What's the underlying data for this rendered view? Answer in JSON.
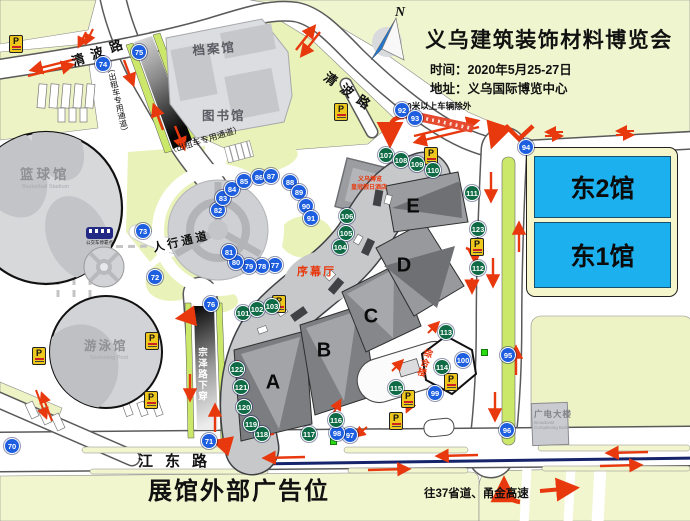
{
  "header": {
    "title": "义乌建筑装饰材料博览会",
    "time": "时间：2020年5月25-27日",
    "address": "地址：义乌国际博览中心",
    "restriction_note": "0米以上车辆除外"
  },
  "compass": {
    "north": "N"
  },
  "roads": {
    "qingbo_west": "清波路",
    "qingbo_east": "清波路",
    "jiangdong": "江东路",
    "zongze_upper": "宗泽路下穿",
    "zongze_lower": "宗泽路下穿",
    "taxi_upper": "（出租车专用通道）",
    "taxi_mid": "（出租车专用通道）",
    "pedestrian": "人行通道",
    "highway_note": "往37省道、甬金高速"
  },
  "footer": {
    "banner": "展馆外部广告位"
  },
  "buildings": {
    "archives": "档案馆",
    "library": "图书馆",
    "basketball": "篮球馆",
    "basketball_en": "Basketball Stadium",
    "swimming": "游泳馆",
    "swimming_en": "Swimming Pool",
    "broadcast": "广电大楼",
    "broadcast_en": "Broadcast Complexing Build",
    "hotel_line1": "义乌博览",
    "hotel_line2": "皇冠假日酒店",
    "prologue_hall": "序幕厅",
    "complex_building": "综合楼",
    "bus_stop": "公交车停靠点"
  },
  "east_halls": {
    "east2": "东2馆",
    "east1": "东1馆"
  },
  "halls": [
    {
      "label": "A",
      "x": 273,
      "y": 383
    },
    {
      "label": "B",
      "x": 324,
      "y": 351
    },
    {
      "label": "C",
      "x": 371,
      "y": 317
    },
    {
      "label": "D",
      "x": 404,
      "y": 266
    },
    {
      "label": "E",
      "x": 413,
      "y": 207
    }
  ],
  "markers": {
    "blue": [
      {
        "n": "70",
        "x": 12,
        "y": 446
      },
      {
        "n": "71",
        "x": 209,
        "y": 441
      },
      {
        "n": "72",
        "x": 155,
        "y": 277
      },
      {
        "n": "73",
        "x": 143,
        "y": 231
      },
      {
        "n": "74",
        "x": 103,
        "y": 64
      },
      {
        "n": "75",
        "x": 139,
        "y": 52
      },
      {
        "n": "76",
        "x": 211,
        "y": 304
      },
      {
        "n": "77",
        "x": 275,
        "y": 265
      },
      {
        "n": "78",
        "x": 262,
        "y": 266
      },
      {
        "n": "79",
        "x": 249,
        "y": 266
      },
      {
        "n": "80",
        "x": 236,
        "y": 262
      },
      {
        "n": "81",
        "x": 229,
        "y": 252
      },
      {
        "n": "82",
        "x": 218,
        "y": 210
      },
      {
        "n": "83",
        "x": 223,
        "y": 198
      },
      {
        "n": "84",
        "x": 232,
        "y": 189
      },
      {
        "n": "85",
        "x": 244,
        "y": 181
      },
      {
        "n": "86",
        "x": 259,
        "y": 177
      },
      {
        "n": "87",
        "x": 271,
        "y": 176
      },
      {
        "n": "88",
        "x": 290,
        "y": 182
      },
      {
        "n": "89",
        "x": 299,
        "y": 192
      },
      {
        "n": "90",
        "x": 306,
        "y": 206
      },
      {
        "n": "91",
        "x": 311,
        "y": 218
      },
      {
        "n": "92",
        "x": 402,
        "y": 110
      },
      {
        "n": "93",
        "x": 415,
        "y": 118
      },
      {
        "n": "94",
        "x": 526,
        "y": 147
      },
      {
        "n": "95",
        "x": 508,
        "y": 355
      },
      {
        "n": "96",
        "x": 507,
        "y": 430
      },
      {
        "n": "97",
        "x": 350,
        "y": 435
      },
      {
        "n": "98",
        "x": 337,
        "y": 433
      },
      {
        "n": "99",
        "x": 435,
        "y": 393
      },
      {
        "n": "100",
        "x": 463,
        "y": 360
      }
    ],
    "green": [
      {
        "n": "101",
        "x": 243,
        "y": 313
      },
      {
        "n": "102",
        "x": 257,
        "y": 309
      },
      {
        "n": "103",
        "x": 272,
        "y": 306
      },
      {
        "n": "104",
        "x": 340,
        "y": 247
      },
      {
        "n": "105",
        "x": 346,
        "y": 233
      },
      {
        "n": "106",
        "x": 347,
        "y": 216
      },
      {
        "n": "107",
        "x": 386,
        "y": 155
      },
      {
        "n": "108",
        "x": 401,
        "y": 160
      },
      {
        "n": "109",
        "x": 417,
        "y": 164
      },
      {
        "n": "110",
        "x": 433,
        "y": 170
      },
      {
        "n": "111",
        "x": 472,
        "y": 193
      },
      {
        "n": "112",
        "x": 478,
        "y": 268
      },
      {
        "n": "113",
        "x": 446,
        "y": 332
      },
      {
        "n": "114",
        "x": 442,
        "y": 367
      },
      {
        "n": "115",
        "x": 396,
        "y": 388
      },
      {
        "n": "116",
        "x": 336,
        "y": 420
      },
      {
        "n": "117",
        "x": 309,
        "y": 434
      },
      {
        "n": "118",
        "x": 262,
        "y": 434
      },
      {
        "n": "119",
        "x": 251,
        "y": 424
      },
      {
        "n": "120",
        "x": 244,
        "y": 407
      },
      {
        "n": "121",
        "x": 241,
        "y": 387
      },
      {
        "n": "122",
        "x": 237,
        "y": 369
      },
      {
        "n": "123",
        "x": 478,
        "y": 229
      }
    ]
  },
  "parking": {
    "symbol": "P",
    "spots": [
      [
        16,
        44
      ],
      [
        341,
        112
      ],
      [
        431,
        156
      ],
      [
        477,
        247
      ],
      [
        408,
        399
      ],
      [
        396,
        421
      ],
      [
        451,
        382
      ],
      [
        39,
        356
      ],
      [
        152,
        341
      ],
      [
        151,
        400
      ],
      [
        279,
        304
      ]
    ]
  },
  "colors": {
    "marker_blue": "#1e5fe0",
    "marker_green": "#0f6b46",
    "east_hall_blue": "#1cb0ee",
    "accent_red": "#e8380d"
  }
}
